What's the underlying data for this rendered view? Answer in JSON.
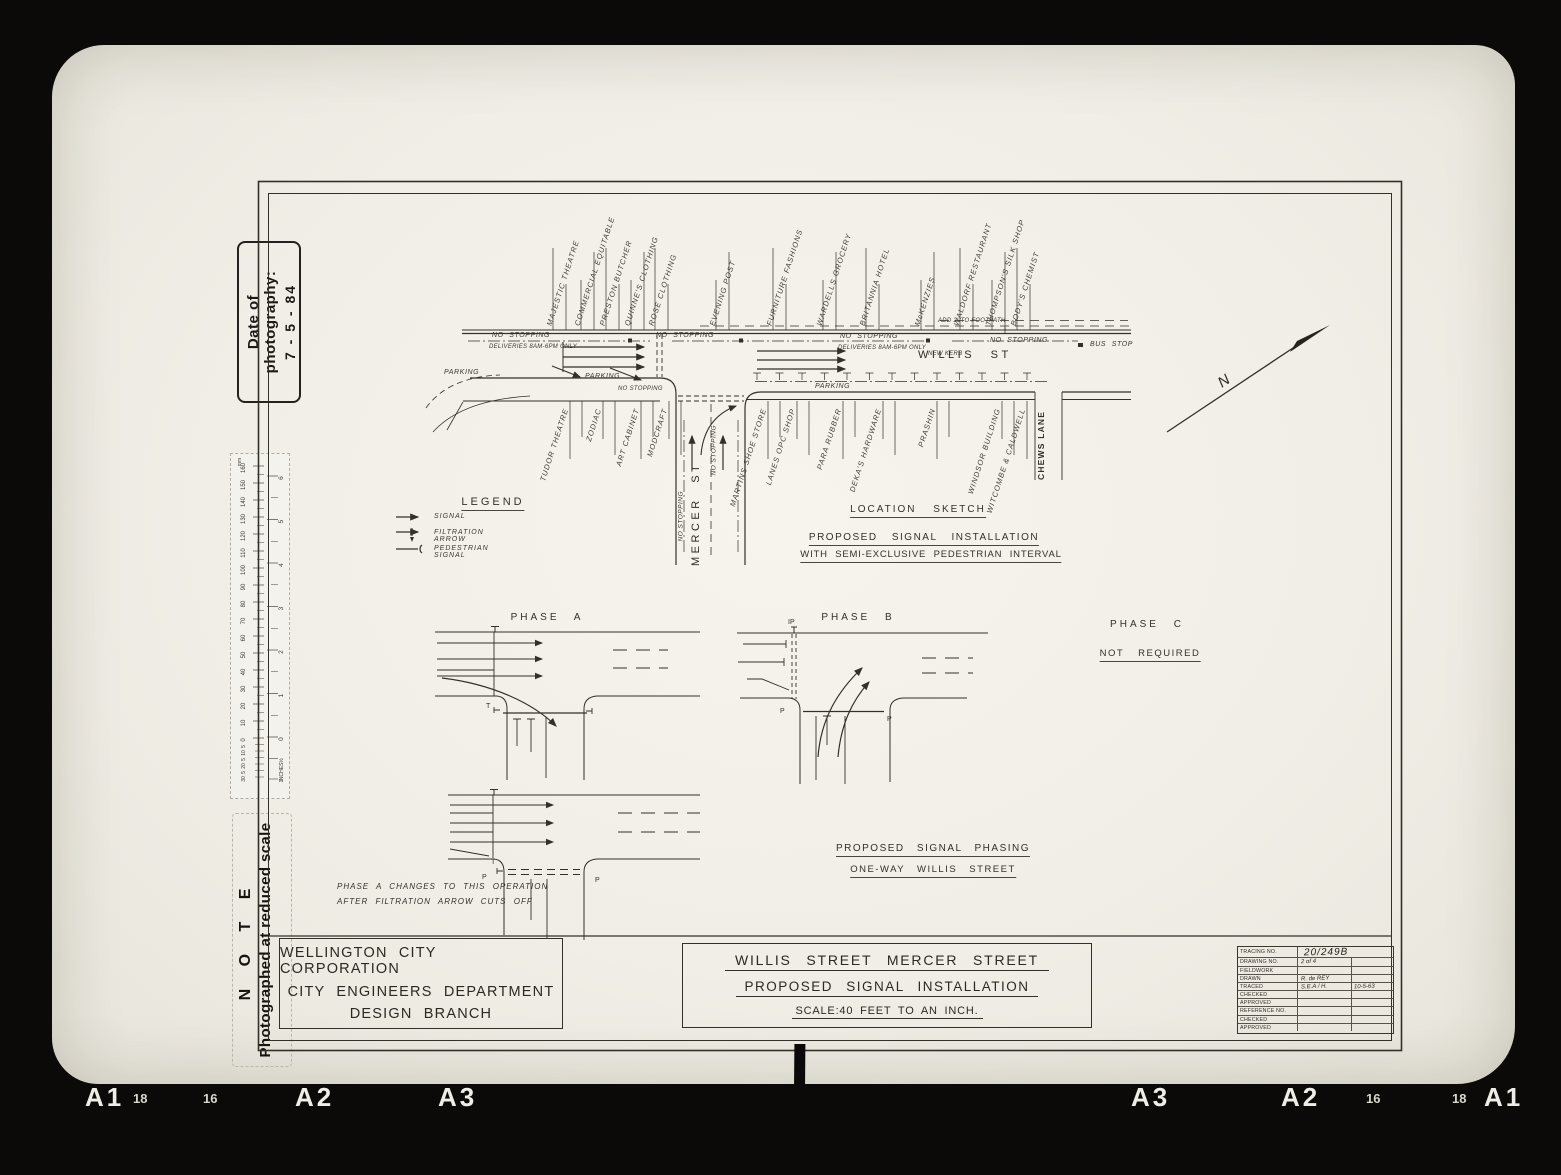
{
  "film": {
    "date_label": "Date of photography:",
    "date_value": "7 - 5 - 84",
    "note_title": "N O T E",
    "note_text": "Photographed at reduced scale",
    "edge_labels": [
      {
        "text": "A1",
        "x": 85,
        "size": "lg"
      },
      {
        "text": "18",
        "x": 133,
        "size": "sm"
      },
      {
        "text": "16",
        "x": 203,
        "size": "sm"
      },
      {
        "text": "A2",
        "x": 295,
        "size": "lg"
      },
      {
        "text": "A3",
        "x": 438,
        "size": "lg"
      },
      {
        "text": "A3",
        "x": 1131,
        "size": "lg"
      },
      {
        "text": "A2",
        "x": 1281,
        "size": "lg"
      },
      {
        "text": "16",
        "x": 1366,
        "size": "sm"
      },
      {
        "text": "18",
        "x": 1452,
        "size": "sm"
      },
      {
        "text": "A1",
        "x": 1484,
        "size": "lg"
      }
    ]
  },
  "ruler": {
    "unit_top": "mm",
    "unit_bottom": "INCHES",
    "mm_labels": [
      "160",
      "150",
      "140",
      "130",
      "120",
      "110",
      "100",
      "90",
      "80",
      "70",
      "60",
      "50",
      "40",
      "30",
      "20",
      "10",
      "0"
    ],
    "mm_sub_labels": [
      "5",
      "10",
      "5",
      "20",
      "5",
      "30"
    ],
    "inch_labels": [
      "6",
      "5",
      "4",
      "3",
      "2",
      "1",
      "0"
    ],
    "inch_sub_labels": [
      "½",
      "1"
    ]
  },
  "sketch": {
    "north_marker": "N",
    "north_buildings": [
      {
        "text": "MAJESTIC THEATRE",
        "x": 549
      },
      {
        "text": "COMMERCIAL EQUITABLE",
        "x": 577
      },
      {
        "text": "PRESTON BUTCHER",
        "x": 602
      },
      {
        "text": "QUINNE'S CLOTHING",
        "x": 627
      },
      {
        "text": "ROSE CLOTHING",
        "x": 651
      },
      {
        "text": "EVENING POST",
        "x": 712
      },
      {
        "text": "FURNITURE FASHIONS",
        "x": 769
      },
      {
        "text": "WARDELLS GROCERY",
        "x": 819
      },
      {
        "text": "BRITANNIA HOTEL",
        "x": 862
      },
      {
        "text": "McKENZIES",
        "x": 917
      },
      {
        "text": "WALDORF RESTAURANT",
        "x": 956
      },
      {
        "text": "THOMPSON'S SILK SHOP",
        "x": 988
      },
      {
        "text": "BODY'S CHEMIST",
        "x": 1013
      }
    ],
    "south_buildings": [
      {
        "text": "TUDOR THEATRE",
        "x": 566
      },
      {
        "text": "ZODIAC",
        "x": 599
      },
      {
        "text": "ART CABINET",
        "x": 637
      },
      {
        "text": "MODCRAFT",
        "x": 665
      },
      {
        "text": "MARTINS SHOE STORE",
        "x": 764
      },
      {
        "text": "LANES OPC SHOP",
        "x": 793
      },
      {
        "text": "PARA RUBBER",
        "x": 839
      },
      {
        "text": "DEKA'S HARDWARE",
        "x": 879
      },
      {
        "text": "PRASHIN",
        "x": 933
      },
      {
        "text": "WINDSOR BUILDING",
        "x": 998
      },
      {
        "text": "WITCOMBE & CALDWELL",
        "x": 1023
      }
    ],
    "annotations": [
      {
        "text": "NO STOPPING",
        "x": 492,
        "y": 332,
        "size": "t"
      },
      {
        "text": "DELIVERIES 8AM-6PM ONLY",
        "x": 489,
        "y": 344,
        "size": "m"
      },
      {
        "text": "NO STOPPING",
        "x": 656,
        "y": 332,
        "size": "t"
      },
      {
        "text": "NO STOPPING",
        "x": 840,
        "y": 333,
        "size": "t"
      },
      {
        "text": "DELIVERIES 8AM-6PM ONLY",
        "x": 838,
        "y": 345,
        "size": "m"
      },
      {
        "text": "ADD 2' TO FOOTPATH",
        "x": 938,
        "y": 318,
        "size": "m"
      },
      {
        "text": "NEW KERB",
        "x": 928,
        "y": 351,
        "size": "m"
      },
      {
        "text": "NO STOPPING",
        "x": 990,
        "y": 337,
        "size": "t"
      },
      {
        "text": "BUS STOP",
        "x": 1090,
        "y": 341,
        "size": "t"
      },
      {
        "text": "WILLIS ST",
        "x": 918,
        "y": 349,
        "size": "st"
      },
      {
        "text": "PARKING",
        "x": 444,
        "y": 369,
        "size": "t"
      },
      {
        "text": "PARKING",
        "x": 585,
        "y": 373,
        "size": "t"
      },
      {
        "text": "NO STOPPING",
        "x": 618,
        "y": 386,
        "size": "m"
      },
      {
        "text": "PARKING",
        "x": 815,
        "y": 383,
        "size": "t"
      }
    ],
    "v_annotations": [
      {
        "text": "NO STOPPING",
        "x": 681,
        "y": 538,
        "size": "m"
      },
      {
        "text": "NO STOPPING",
        "x": 714,
        "y": 472,
        "size": "m"
      },
      {
        "text": "MERCER ST",
        "x": 696,
        "y": 560,
        "size": "st"
      },
      {
        "text": "CHEWS LANE",
        "x": 1041,
        "y": 475,
        "size": "ln"
      }
    ]
  },
  "legend": {
    "title": "LEGEND",
    "items": [
      {
        "label": "SIGNAL",
        "symbol": "signal-arrow"
      },
      {
        "label": "FILTRATION ARROW",
        "symbol": "filtration-arrow"
      },
      {
        "label": "PEDESTRIAN SIGNAL",
        "symbol": "pedestrian-signal"
      }
    ]
  },
  "location_block": {
    "line1": "LOCATION SKETCH",
    "line2": "PROPOSED SIGNAL INSTALLATION",
    "line3": "WITH SEMI-EXCLUSIVE PEDESTRIAN INTERVAL"
  },
  "phases": {
    "a_label": "PHASE A",
    "b_label": "PHASE B",
    "c_label": "PHASE C",
    "c_note": "NOT REQUIRED",
    "b_marker": "IP",
    "p_marker": "P",
    "t_marker": "T",
    "change_note_line1": "PHASE A CHANGES TO THIS OPERATION",
    "change_note_line2": "AFTER FILTRATION ARROW CUTS OFF",
    "phasing_title": "PROPOSED SIGNAL PHASING",
    "phasing_subtitle": "ONE-WAY WILLIS STREET"
  },
  "title_block": {
    "org_line1": "WELLINGTON CITY CORPORATION",
    "org_line2": "CITY ENGINEERS DEPARTMENT",
    "org_line3": "DESIGN BRANCH",
    "title_line1": "WILLIS STREET MERCER STREET",
    "title_line2": "PROPOSED SIGNAL INSTALLATION",
    "scale": "SCALE:40 FEET TO AN INCH."
  },
  "tracing_table": {
    "rows": [
      {
        "label": "TRACING NO.",
        "value": "20/249B",
        "value2": "",
        "cls": "hand-lg",
        "span": true
      },
      {
        "label": "DRAWING NO.",
        "value": "2 of 4",
        "value2": "",
        "cls": "hand"
      },
      {
        "label": "FIELDWORK",
        "value": "",
        "value2": "",
        "cls": "hand"
      },
      {
        "label": "DRAWN",
        "value": "R. de REY",
        "value2": "",
        "cls": "hand"
      },
      {
        "label": "TRACED",
        "value": "S.E.A / H.",
        "value2": "10-5-63",
        "cls": "hand"
      },
      {
        "label": "CHECKED",
        "value": "",
        "value2": "",
        "cls": "hand"
      },
      {
        "label": "APPROVED",
        "value": "",
        "value2": "",
        "cls": "hand"
      },
      {
        "label": "REFERENCE NO.",
        "value": "",
        "value2": "",
        "cls": "hand"
      },
      {
        "label": "CHECKED",
        "value": "",
        "value2": "",
        "cls": "hand"
      },
      {
        "label": "APPROVED",
        "value": "",
        "value2": "",
        "cls": "hand"
      }
    ]
  }
}
